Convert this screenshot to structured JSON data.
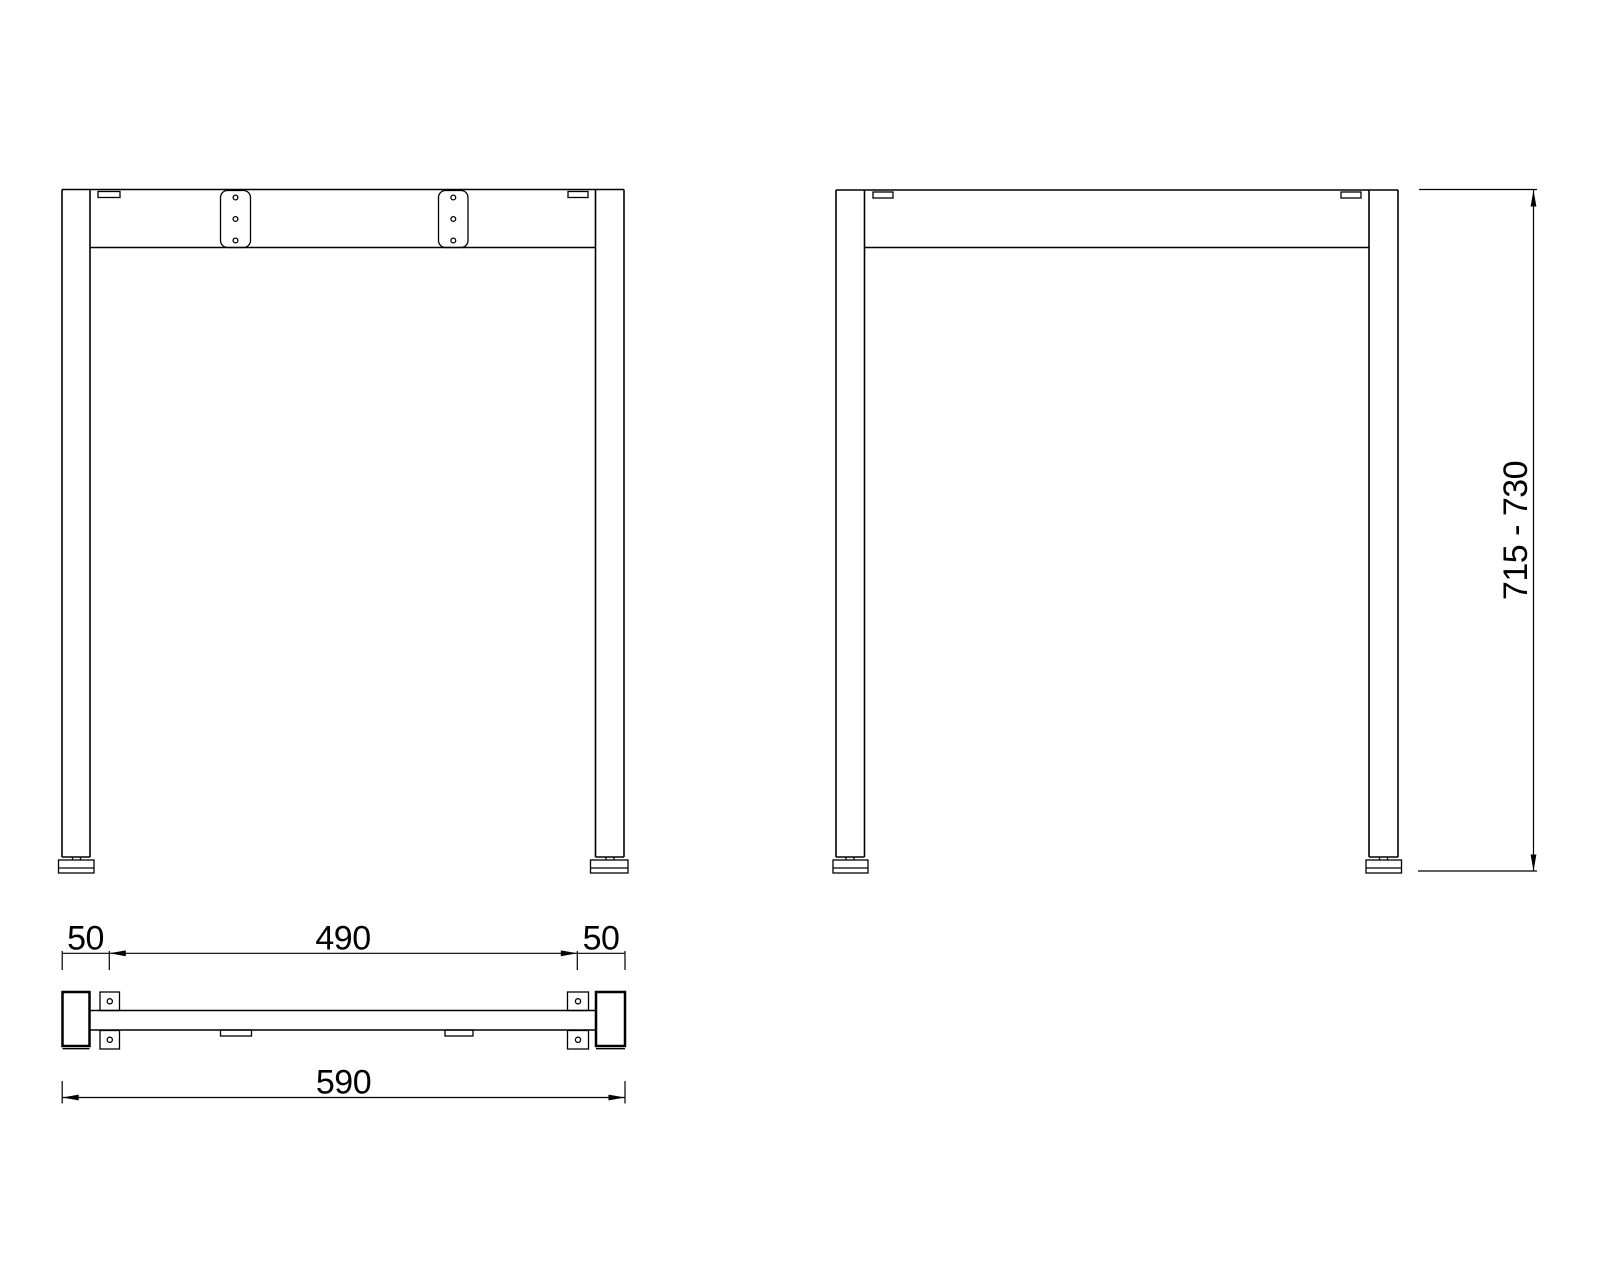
{
  "colors": {
    "background": "#ffffff",
    "line": "#000000",
    "text": "#000000"
  },
  "dimensions": {
    "left_overhang": "50",
    "hole_spacing": "490",
    "right_overhang": "50",
    "overall_width": "590",
    "height_range": "715 - 730"
  }
}
